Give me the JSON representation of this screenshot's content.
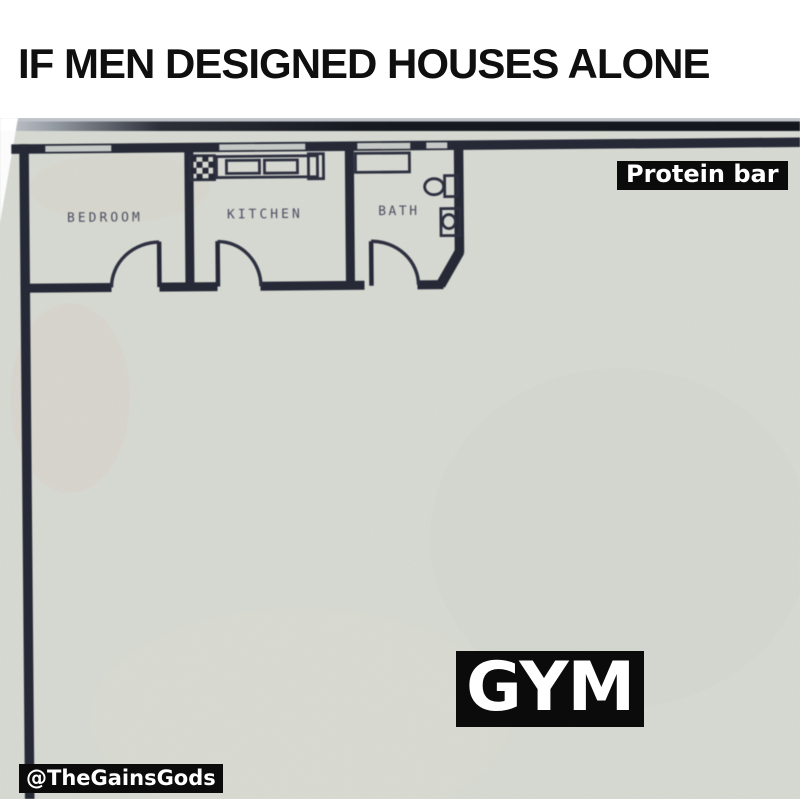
{
  "title": "IF MEN DESIGNED HOUSES ALONE",
  "floor_plan": {
    "room_labels": {
      "bedroom": "BEDROOM",
      "kitchen": "KITCHEN",
      "bath": "BATH"
    },
    "annotations": {
      "protein_bar": "Protein bar",
      "gym": "GYM"
    }
  },
  "watermark": "@TheGainsGods",
  "colors": {
    "wall": "#242734",
    "floor": "#d8dbd3",
    "fixture_line": "#2b2e3e",
    "room_label_text": "#4a4d60",
    "annotation_bg": "#0b0b0b",
    "annotation_text": "#ffffff",
    "title_text": "#0f0f0f"
  }
}
